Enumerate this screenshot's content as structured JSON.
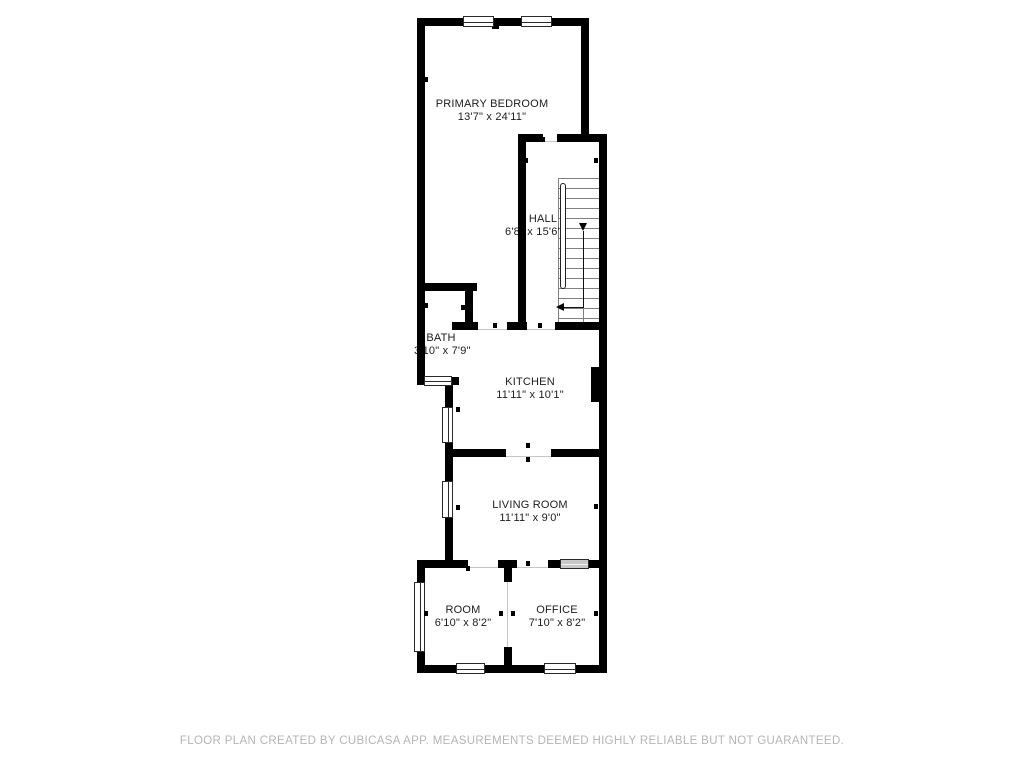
{
  "rooms": {
    "primary_bedroom": {
      "name": "PRIMARY BEDROOM",
      "dimensions": "13'7\" x 24'11\""
    },
    "hall": {
      "name": "HALL",
      "dimensions": "6'8\" x 15'6\""
    },
    "bath": {
      "name": "BATH",
      "dimensions": "3'10\" x 7'9\""
    },
    "kitchen": {
      "name": "KITCHEN",
      "dimensions": "11'11\" x 10'1\""
    },
    "living_room": {
      "name": "LIVING ROOM",
      "dimensions": "11'11\" x 9'0\""
    },
    "room": {
      "name": "ROOM",
      "dimensions": "6'10\" x 8'2\""
    },
    "office": {
      "name": "OFFICE",
      "dimensions": "7'10\" x 8'2\""
    }
  },
  "footer": {
    "disclaimer": "FLOOR PLAN CREATED BY CUBICASA APP. MEASUREMENTS DEEMED HIGHLY RELIABLE BUT NOT GUARANTEED."
  },
  "colors": {
    "wall": "#000000",
    "background": "#ffffff",
    "label_text": "#1c1c1c",
    "footer_text": "#b5b5b5",
    "stair_line": "#808080",
    "window_fill": "#ffffff",
    "interior_window_fill": "#c8c8c8"
  }
}
